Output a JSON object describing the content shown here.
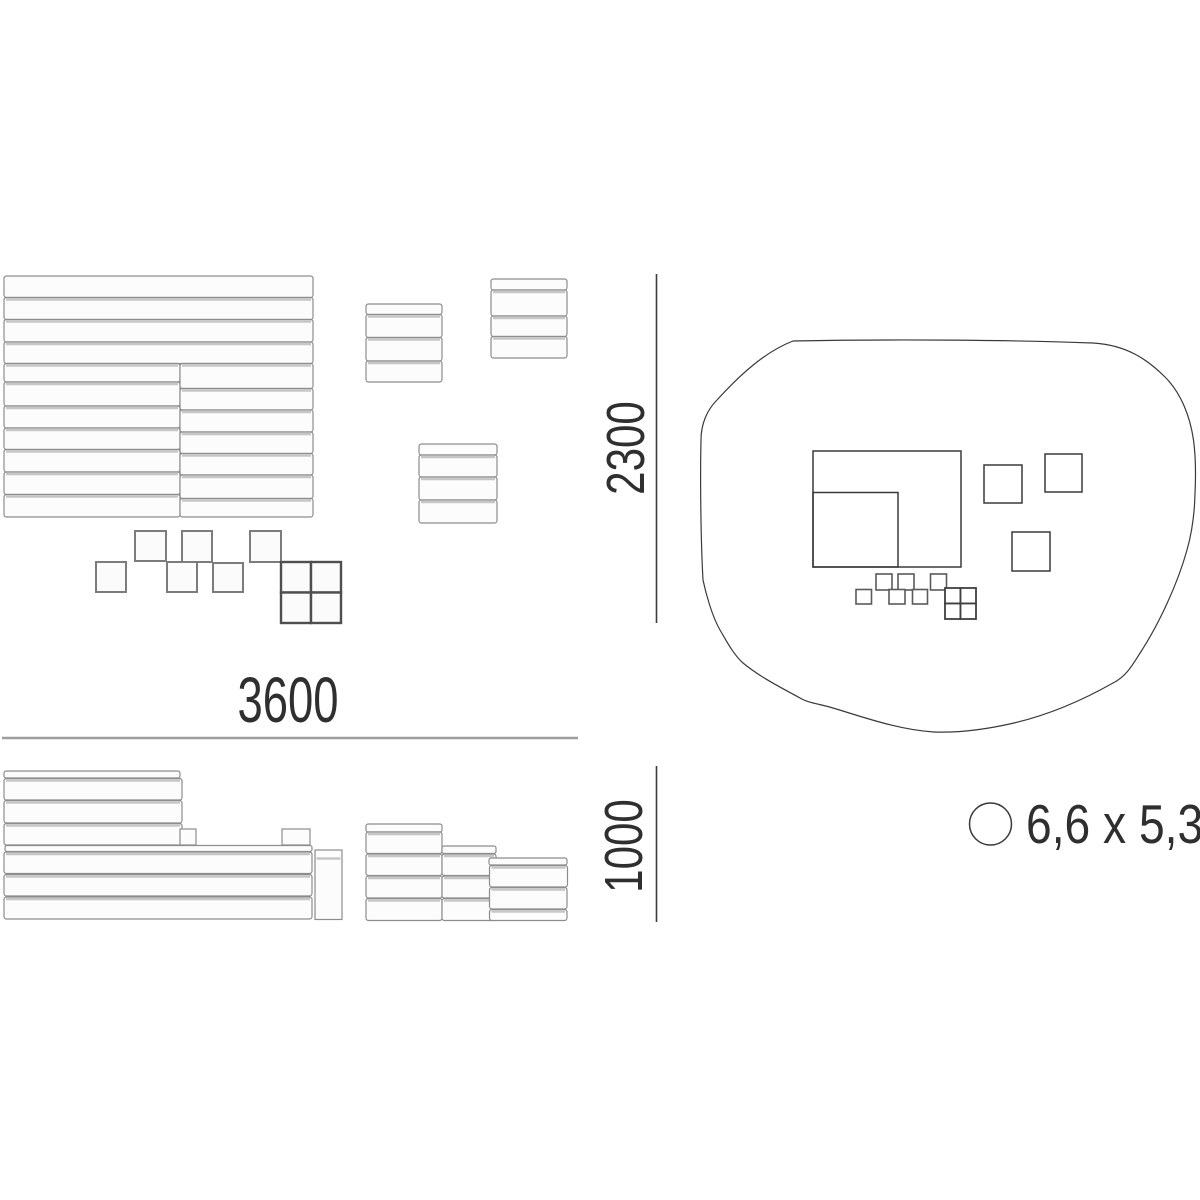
{
  "dimension_labels": {
    "width": "3600",
    "depth": "2300",
    "height": "1000"
  },
  "footprint_label": "6,6 x 5,3",
  "colors": {
    "background": "#ffffff",
    "drawing_line": "#3a3a3a",
    "dimension_line_gray": "#9e9e9e",
    "dimension_line_dark": "#3d3d3d",
    "slat_fill": "#fcfcfc",
    "slat_stroke": "#8d8d8d",
    "text": "#2f2f2f"
  }
}
